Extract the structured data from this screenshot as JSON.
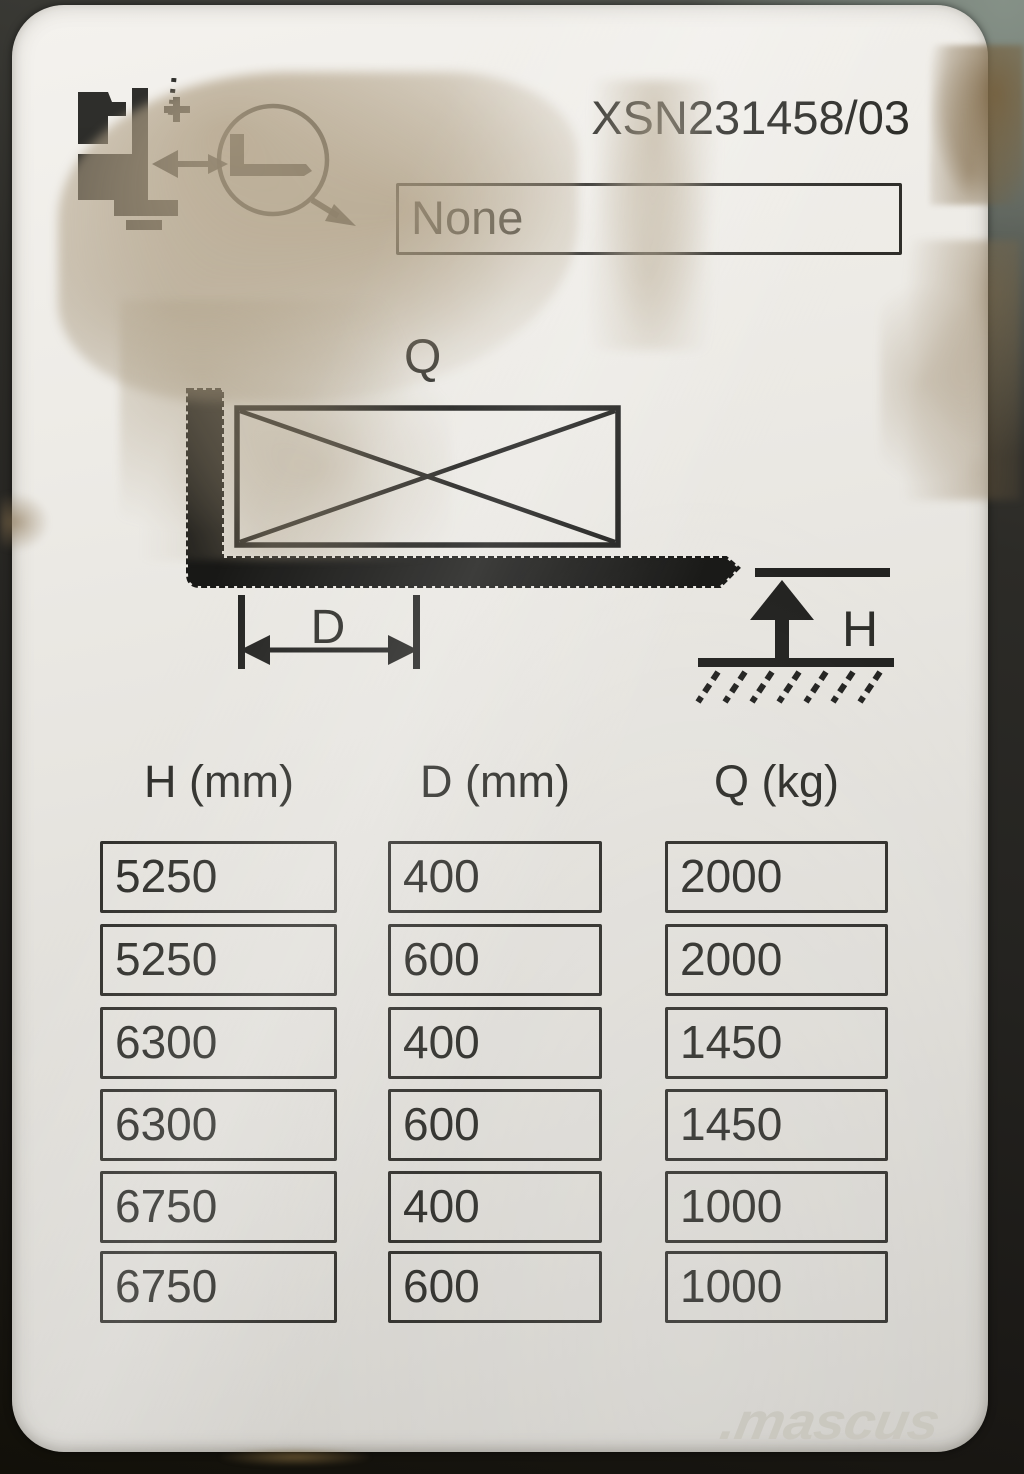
{
  "plate": {
    "serial_number": "XSN231458/03",
    "attachment_field": {
      "value": "None"
    },
    "pictogram": {
      "icons": [
        "forklift-icon",
        "load-center-magnifier-icon",
        "left-arrow-icon"
      ]
    },
    "diagram": {
      "load_label": "Q",
      "load_center_label": "D",
      "lift_height_label": "H"
    },
    "capacity_table": {
      "columns": [
        "H (mm)",
        "D (mm)",
        "Q (kg)"
      ],
      "rows": [
        [
          "5250",
          "400",
          "2000"
        ],
        [
          "5250",
          "600",
          "2000"
        ],
        [
          "6300",
          "400",
          "1450"
        ],
        [
          "6300",
          "600",
          "1450"
        ],
        [
          "6750",
          "400",
          "1000"
        ],
        [
          "6750",
          "600",
          "1000"
        ]
      ]
    }
  },
  "watermark": {
    "text": ".mascus"
  },
  "colors": {
    "plate": "#e9e7e2",
    "ink": "#2d2d29",
    "background_dark": "#23221f",
    "stain": "#b5a68c",
    "watermark": "#c9c7be"
  }
}
